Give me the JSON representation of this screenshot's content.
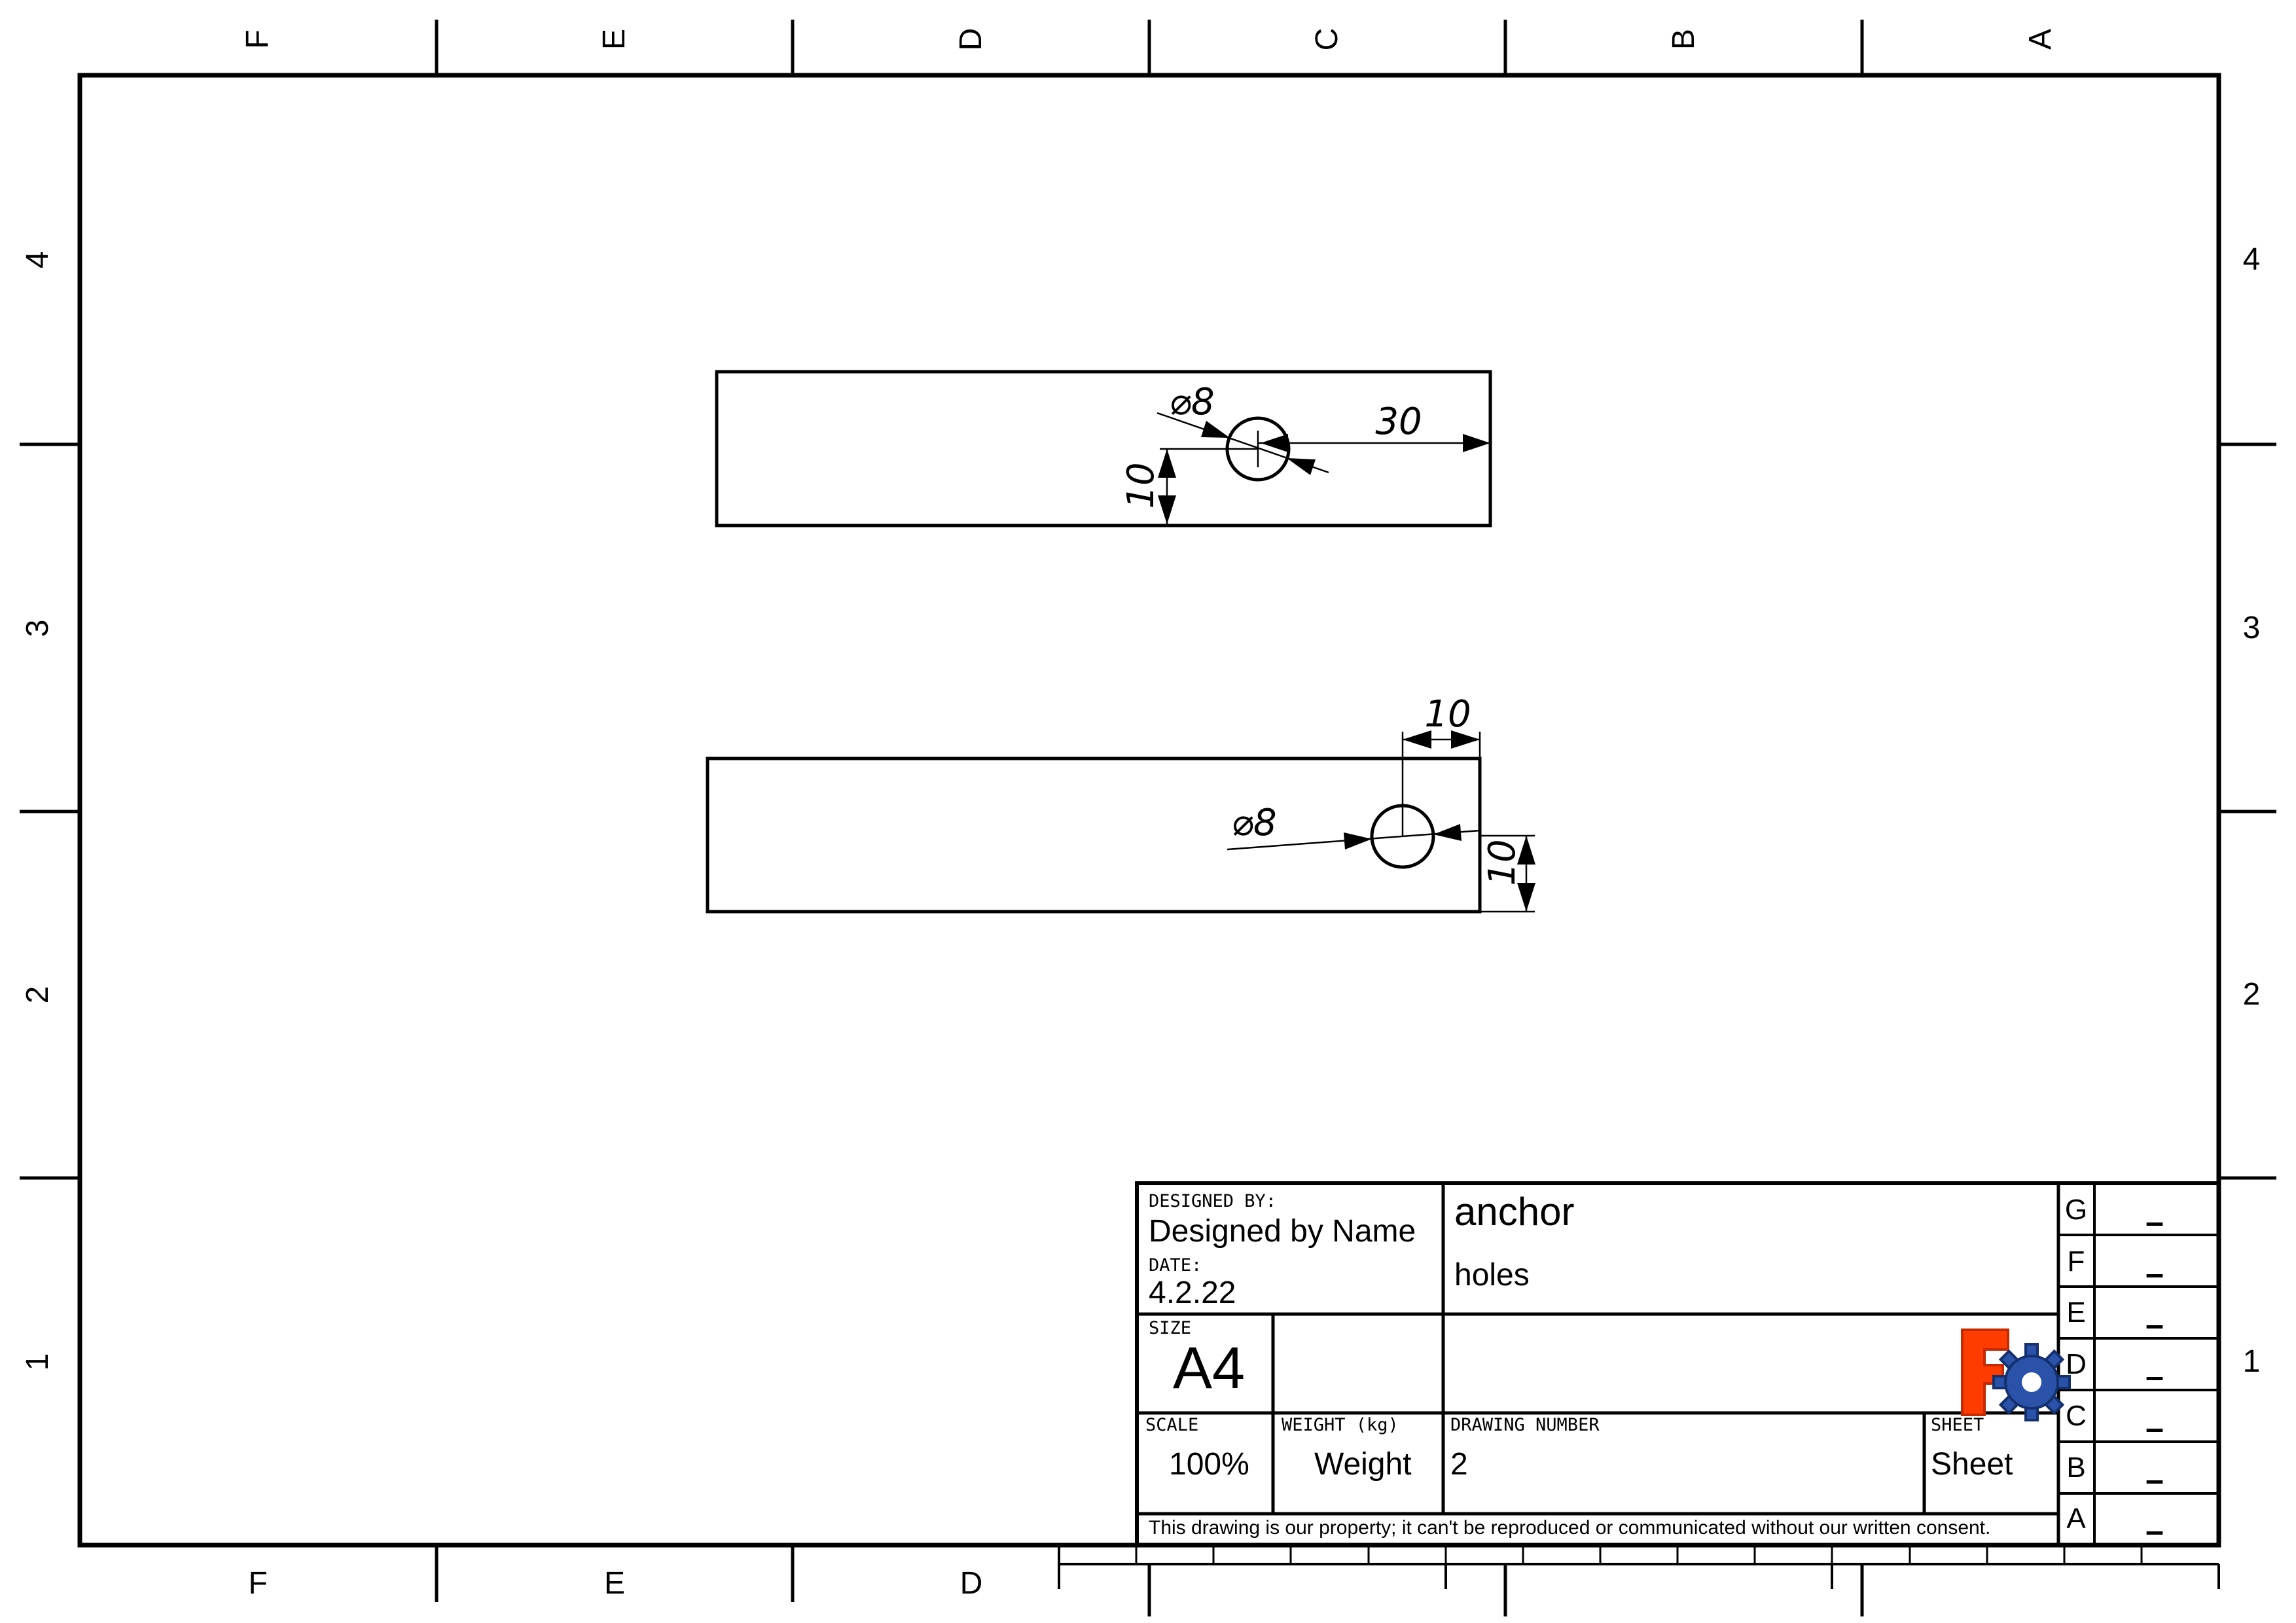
{
  "page": {
    "background": "#ffffff",
    "line_color": "#000000"
  },
  "zones": {
    "top": [
      "F",
      "E",
      "D",
      "C",
      "B",
      "A"
    ],
    "bottom": [
      "F",
      "E",
      "D"
    ],
    "left": [
      "4",
      "3",
      "2",
      "1"
    ],
    "right": [
      "4",
      "3",
      "2",
      "1"
    ]
  },
  "views": {
    "front": {
      "diameter": "⌀8",
      "width_dim": "30",
      "height_dim": "10"
    },
    "top": {
      "offset_dim": "10",
      "diameter": "⌀8",
      "height_dim": "10"
    }
  },
  "title_block": {
    "designed_by_label": "DESIGNED BY:",
    "designed_by": "Designed by Name",
    "date_label": "DATE:",
    "date": "4.2.22",
    "title": "anchor",
    "subtitle": "holes",
    "size_label": "SIZE",
    "size": "A4",
    "scale_label": "SCALE",
    "scale": "100%",
    "weight_label": "WEIGHT (kg)",
    "weight": "Weight",
    "drawing_number_label": "DRAWING NUMBER",
    "drawing_number": "2",
    "sheet_label": "SHEET",
    "sheet": "Sheet",
    "disclaimer": "This drawing is our property; it can't be reproduced or communicated without our written consent."
  },
  "revisions": [
    {
      "letter": "G",
      "value": "–"
    },
    {
      "letter": "F",
      "value": "–"
    },
    {
      "letter": "E",
      "value": "–"
    },
    {
      "letter": "D",
      "value": "–"
    },
    {
      "letter": "C",
      "value": "–"
    },
    {
      "letter": "B",
      "value": "–"
    },
    {
      "letter": "A",
      "value": "–"
    }
  ],
  "logo": {
    "name": "freecad-logo",
    "f_color": "#ff3c00",
    "f_dark": "#c62b00",
    "gear_color": "#2a52a8",
    "gear_dark": "#14306e"
  }
}
